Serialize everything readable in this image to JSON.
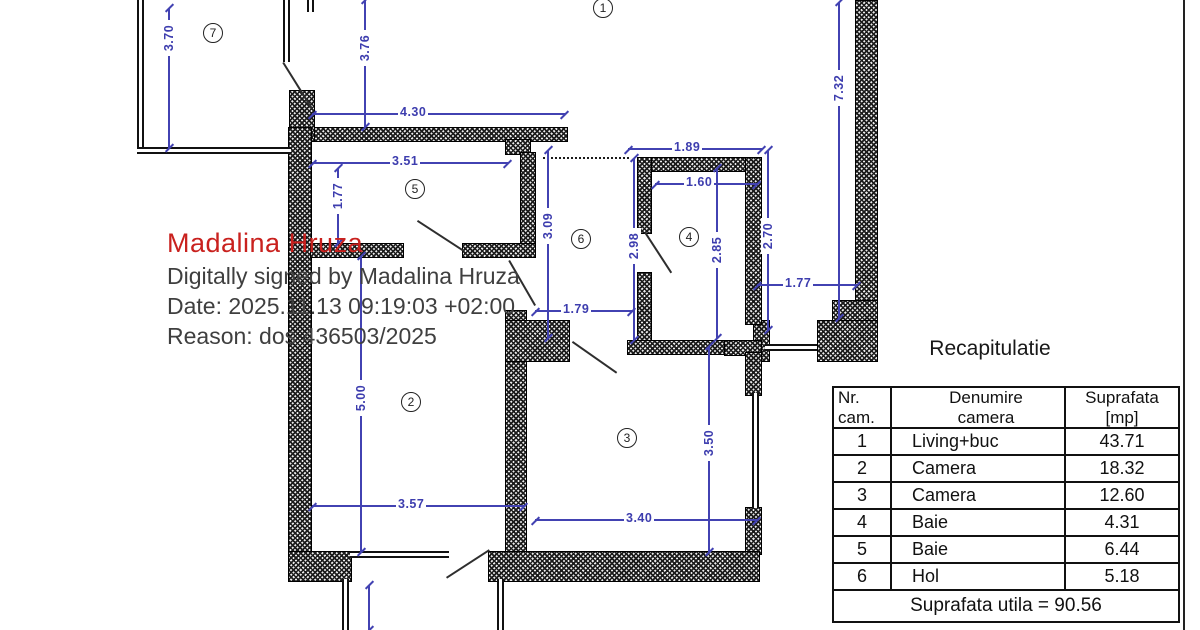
{
  "signature": {
    "name": "Madalina Hruza",
    "line1": "Digitally signed by Madalina Hruza",
    "line2": "Date: 2025.11.13 09:19:03 +02:00",
    "line3": "Reason: dos 436503/2025",
    "name_color": "#c9211e",
    "text_color": "#3f3f3f"
  },
  "plan": {
    "dimension_color": "#4242b2",
    "room_numbers": {
      "r1": "1",
      "r2": "2",
      "r3": "3",
      "r4": "4",
      "r5": "5",
      "r6": "6",
      "r7": "7"
    },
    "dims": {
      "v370": "3.70",
      "v376": "3.76",
      "h430": "4.30",
      "h351": "3.51",
      "v177": "1.77",
      "v309": "3.09",
      "h189": "1.89",
      "h160": "1.60",
      "v298": "2.98",
      "v285": "2.85",
      "v270": "2.70",
      "v732": "7.32",
      "h177": "1.77",
      "h179": "1.79",
      "v500": "5.00",
      "h357": "3.57",
      "h340": "3.40",
      "v350": "3.50"
    }
  },
  "recap": {
    "title": "Recapitulatie",
    "headers": {
      "nr_line1": "Nr.",
      "nr_line2": "cam.",
      "name_line1": "Denumire",
      "name_line2": "camera",
      "area_line1": "Suprafata",
      "area_line2": "[mp]"
    },
    "rows": [
      {
        "nr": "1",
        "name": "Living+buc",
        "area": "43.71"
      },
      {
        "nr": "2",
        "name": "Camera",
        "area": "18.32"
      },
      {
        "nr": "3",
        "name": "Camera",
        "area": "12.60"
      },
      {
        "nr": "4",
        "name": "Baie",
        "area": "4.31"
      },
      {
        "nr": "5",
        "name": "Baie",
        "area": "6.44"
      },
      {
        "nr": "6",
        "name": "Hol",
        "area": "5.18"
      }
    ],
    "footer": "Suprafata utila = 90.56"
  }
}
